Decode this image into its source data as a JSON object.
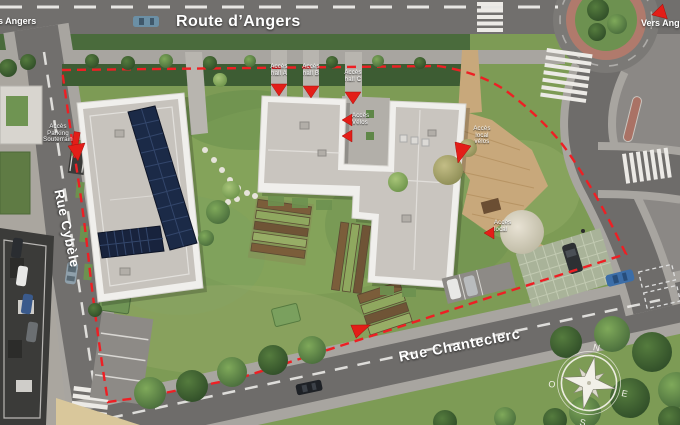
{
  "streets": {
    "route_dangers": "Route d’Angers",
    "rue_cybele": "Rue Cybèle",
    "rue_chanteclerc": "Rue Chanteclerc",
    "vers_angers_left": "Vers Angers",
    "vers_angers_right": "Vers Angers"
  },
  "annotations": {
    "acces_parking": "Accès\nParking\nSouterrain",
    "acces_hall_a": "Accès\nhall A",
    "acces_hall_b": "Accès\nhall B",
    "acces_hall_c": "Accès\nhall C",
    "acces_velos": "Accès\nVélos",
    "acces_local": "Accès\nlocal\nvélos",
    "acces_local_2": "Accès\nlocal"
  },
  "compass": {
    "north": "N",
    "east": "E",
    "south": "S",
    "west": "O"
  },
  "colors": {
    "boundary_red": "#ee1f24",
    "arrow_red": "#e31e18",
    "road_gray": "#6f6d6b",
    "sidewalk_gray": "#a8a5a0",
    "grass_green": "#7d9b55",
    "solar_blue": "#1b2a47",
    "deck_wood": "#c8a87b",
    "roundabout_ring": "#b07a6c"
  }
}
